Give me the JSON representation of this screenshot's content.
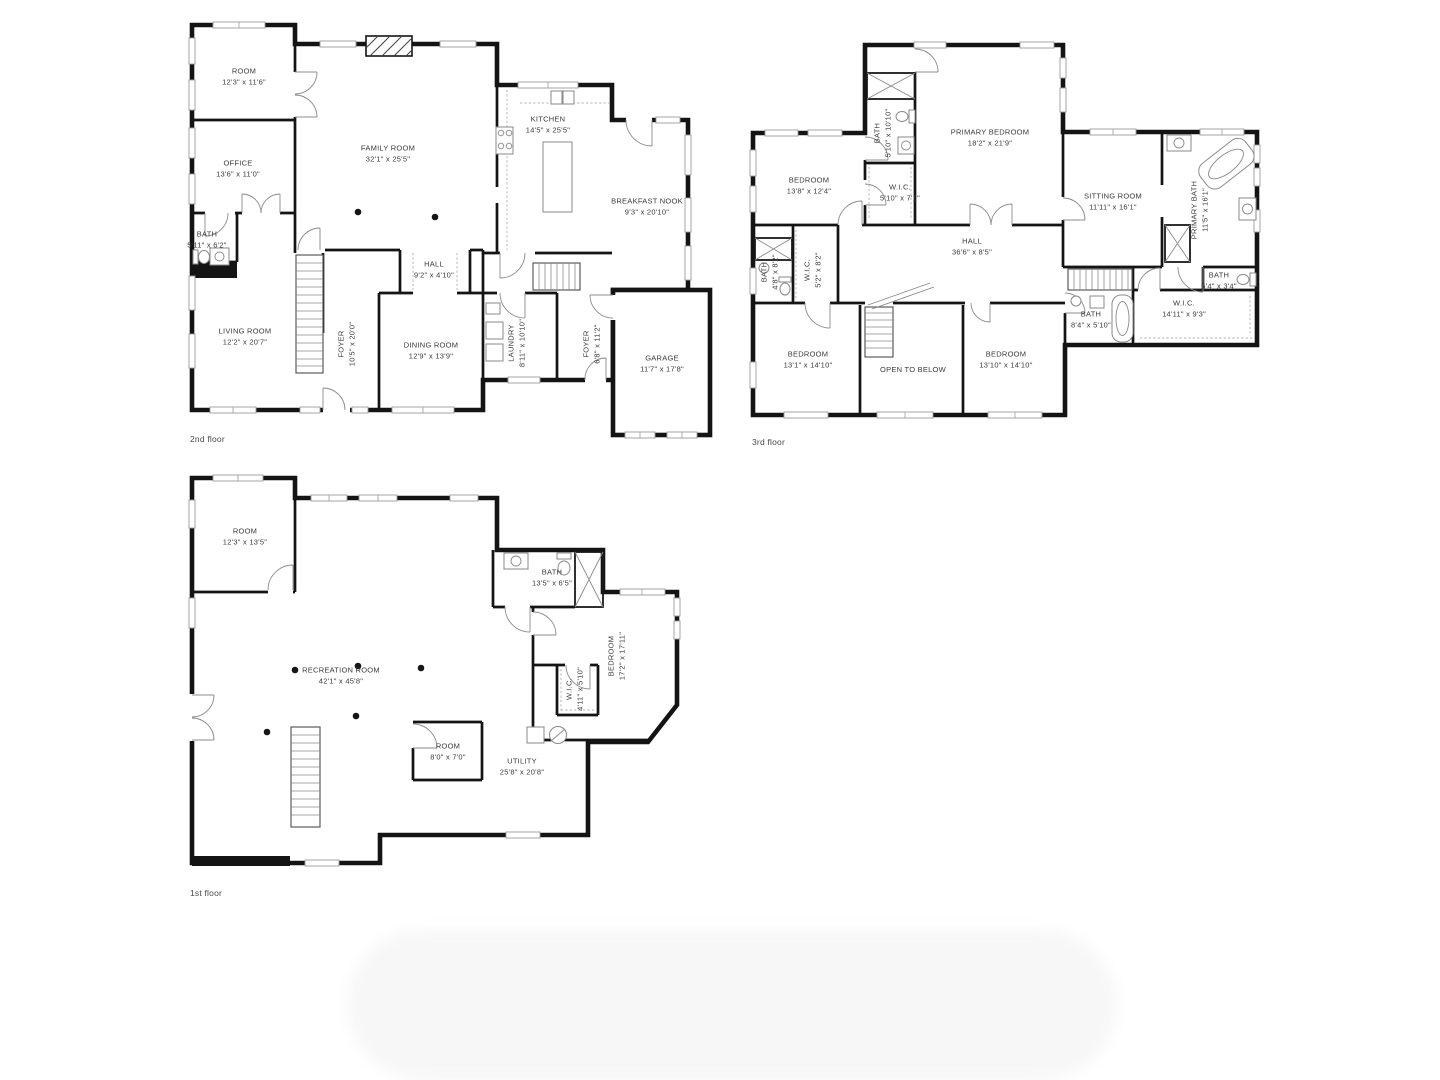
{
  "colors": {
    "wall": "#141414",
    "text": "#3a3a3a",
    "fixture": "#8a8a8a"
  },
  "floors": [
    {
      "id": "floor-2",
      "label": "2nd floor",
      "label_pos": {
        "x": 190,
        "y": 434
      },
      "rooms": [
        {
          "name": "ROOM",
          "dims": "12'3\" x 11'6\"",
          "x": 244,
          "y": 77,
          "rotate": 0
        },
        {
          "name": "OFFICE",
          "dims": "13'6\" x 11'0\"",
          "x": 238,
          "y": 169,
          "rotate": 0
        },
        {
          "name": "BATH",
          "dims": "5'11\" x 6'2\"",
          "x": 207,
          "y": 240,
          "rotate": 0
        },
        {
          "name": "FAMILY ROOM",
          "dims": "32'1\" x 25'5\"",
          "x": 388,
          "y": 154,
          "rotate": 0
        },
        {
          "name": "KITCHEN",
          "dims": "14'5\" x 25'5\"",
          "x": 548,
          "y": 125,
          "rotate": 0
        },
        {
          "name": "BREAKFAST NOOK",
          "dims": "9'3\" x 20'10\"",
          "x": 647,
          "y": 207,
          "rotate": 0
        },
        {
          "name": "HALL",
          "dims": "9'2\" x 4'10\"",
          "x": 434,
          "y": 270,
          "rotate": 0
        },
        {
          "name": "LIVING ROOM",
          "dims": "12'2\" x 20'7\"",
          "x": 245,
          "y": 337,
          "rotate": 0
        },
        {
          "name": "FOYER",
          "dims": "10'5\" x 20'0\"",
          "x": 347,
          "y": 344,
          "rotate": 1
        },
        {
          "name": "DINING ROOM",
          "dims": "12'9\" x 13'9\"",
          "x": 431,
          "y": 351,
          "rotate": 0
        },
        {
          "name": "LAUNDRY",
          "dims": "8'11\" x 10'10\"",
          "x": 517,
          "y": 343,
          "rotate": 1
        },
        {
          "name": "FOYER",
          "dims": "6'8\" x 11'2\"",
          "x": 592,
          "y": 344,
          "rotate": 1
        },
        {
          "name": "GARAGE",
          "dims": "11'7\" x 17'8\"",
          "x": 662,
          "y": 364,
          "rotate": 0
        }
      ]
    },
    {
      "id": "floor-3",
      "label": "3rd floor",
      "label_pos": {
        "x": 752,
        "y": 437
      },
      "rooms": [
        {
          "name": "BEDROOM",
          "dims": "13'8\" x 12'4\"",
          "x": 809,
          "y": 186,
          "rotate": 0
        },
        {
          "name": "BATH",
          "dims": "5'10\" x 10'10\"",
          "x": 883,
          "y": 133,
          "rotate": 1
        },
        {
          "name": "PRIMARY BEDROOM",
          "dims": "18'2\" x 21'9\"",
          "x": 990,
          "y": 138,
          "rotate": 0
        },
        {
          "name": "W.I.C.",
          "dims": "5'10\" x 7'1\"",
          "x": 900,
          "y": 193,
          "rotate": 0
        },
        {
          "name": "SITTING ROOM",
          "dims": "11'11\" x 16'1\"",
          "x": 1113,
          "y": 202,
          "rotate": 0
        },
        {
          "name": "PRIMARY BATH",
          "dims": "11'5\" x 16'1\"",
          "x": 1200,
          "y": 210,
          "rotate": 1
        },
        {
          "name": "HALL",
          "dims": "36'6\" x 8'5\"",
          "x": 972,
          "y": 247,
          "rotate": 0
        },
        {
          "name": "BATH",
          "dims": "4'8\" x 8'2\"",
          "x": 770,
          "y": 272,
          "rotate": 1
        },
        {
          "name": "W.I.C.",
          "dims": "5'2\" x 8'2\"",
          "x": 813,
          "y": 270,
          "rotate": 1
        },
        {
          "name": "BATH",
          "dims": "8'4\" x 5'10\"",
          "x": 1091,
          "y": 320,
          "rotate": 0
        },
        {
          "name": "BATH",
          "dims": "6'4\" x 3'4\"",
          "x": 1219,
          "y": 281,
          "rotate": 0
        },
        {
          "name": "W.I.C.",
          "dims": "14'11\" x 9'3\"",
          "x": 1184,
          "y": 309,
          "rotate": 0
        },
        {
          "name": "BEDROOM",
          "dims": "13'1\" x 14'10\"",
          "x": 808,
          "y": 360,
          "rotate": 0
        },
        {
          "name": "OPEN TO BELOW",
          "dims": "",
          "x": 913,
          "y": 370,
          "rotate": 0
        },
        {
          "name": "BEDROOM",
          "dims": "13'10\" x 14'10\"",
          "x": 1006,
          "y": 360,
          "rotate": 0
        }
      ]
    },
    {
      "id": "floor-1",
      "label": "1st floor",
      "label_pos": {
        "x": 190,
        "y": 888
      },
      "rooms": [
        {
          "name": "ROOM",
          "dims": "12'3\" x 13'5\"",
          "x": 245,
          "y": 537,
          "rotate": 0
        },
        {
          "name": "BATH",
          "dims": "13'5\" x 6'5\"",
          "x": 552,
          "y": 578,
          "rotate": 0
        },
        {
          "name": "RECREATION ROOM",
          "dims": "42'1\" x 45'8\"",
          "x": 341,
          "y": 676,
          "rotate": 0
        },
        {
          "name": "BEDROOM",
          "dims": "17'2\" x 17'11\"",
          "x": 617,
          "y": 656,
          "rotate": 1
        },
        {
          "name": "W.I.C.",
          "dims": "4'11\" x 5'10\"",
          "x": 575,
          "y": 689,
          "rotate": 1
        },
        {
          "name": "ROOM",
          "dims": "8'0\" x 7'0\"",
          "x": 448,
          "y": 752,
          "rotate": 0
        },
        {
          "name": "UTILITY",
          "dims": "25'8\" x 20'8\"",
          "x": 522,
          "y": 767,
          "rotate": 0
        }
      ]
    }
  ]
}
